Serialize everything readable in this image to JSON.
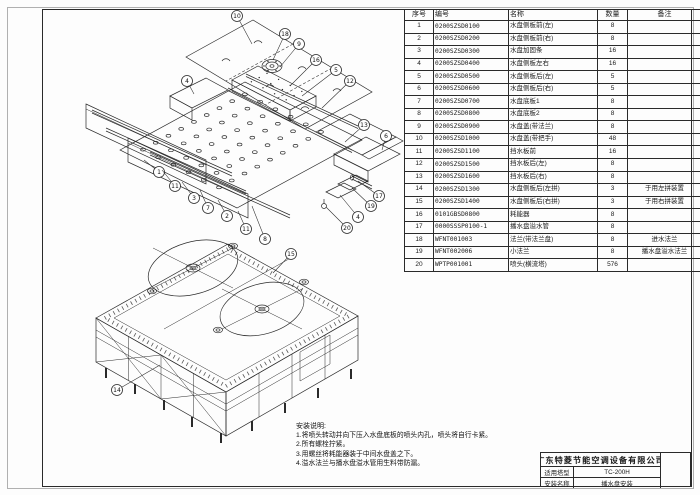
{
  "parts_table": {
    "headers": [
      "序号",
      "编号",
      "名称",
      "数量",
      "备注"
    ],
    "rows": [
      [
        "1",
        "0200SZSD0100",
        "水盘侧板前(左)",
        "8",
        ""
      ],
      [
        "2",
        "0200SZSD0200",
        "水盘侧板前(右)",
        "8",
        ""
      ],
      [
        "3",
        "0200SZSD0300",
        "水盘加固条",
        "16",
        ""
      ],
      [
        "4",
        "0200SZSD0400",
        "水盘侧板左右",
        "16",
        ""
      ],
      [
        "5",
        "0200SZSD0500",
        "水盘侧板后(左)",
        "5",
        ""
      ],
      [
        "6",
        "0200SZSD0600",
        "水盘侧板后(右)",
        "5",
        ""
      ],
      [
        "7",
        "0200SZSD0700",
        "水盘底板1",
        "8",
        ""
      ],
      [
        "8",
        "0200SZSD0800",
        "水盘底板2",
        "8",
        ""
      ],
      [
        "9",
        "0200SZSD0900",
        "水盘盖(带法兰)",
        "8",
        ""
      ],
      [
        "10",
        "0200SZSD1000",
        "水盘盖(带把手)",
        "48",
        ""
      ],
      [
        "11",
        "0200SZSD1100",
        "挡水板前",
        "16",
        ""
      ],
      [
        "12",
        "0200SZSD1500",
        "挡水板后(左)",
        "8",
        ""
      ],
      [
        "13",
        "0200SZSD1600",
        "挡水板后(右)",
        "8",
        ""
      ],
      [
        "14",
        "0200SZSD1300",
        "水盘侧板后(左拼)",
        "3",
        "于用左拼装置"
      ],
      [
        "15",
        "0200SZSD1400",
        "水盘侧板后(右拼)",
        "3",
        "于用右拼装置"
      ],
      [
        "16",
        "0101GBSD0800",
        "耗能器",
        "8",
        ""
      ],
      [
        "17",
        "0000SSSP0100-1",
        "播水盘溢水管",
        "8",
        ""
      ],
      [
        "18",
        "WFNT001003",
        "法兰(带法兰盘)",
        "8",
        "进水法兰"
      ],
      [
        "19",
        "WFNT002006",
        "小法兰",
        "8",
        "播水盘溢水法兰"
      ],
      [
        "20",
        "WPTP001001",
        "喷头(横流塔)",
        "576",
        ""
      ]
    ]
  },
  "notes": {
    "title": "安装说明:",
    "lines": [
      "1.将喷头转动并向下压入水盘底板的喷头内孔，喷头将自行卡紧。",
      "2.所有螺栓拧紧。",
      "3.用螺丝将耗能器装于中间水盘盖之下。",
      "4.溢水法兰与播水盘溢水管用生料带防漏。"
    ]
  },
  "title_block": {
    "company": "广东特菱节能空调设备有限公司",
    "rows": [
      {
        "label": "适用塔型",
        "value": "TC-200H"
      },
      {
        "label": "安装名称",
        "value": "播水盘安装"
      }
    ]
  },
  "diagram": {
    "line_color": "#2a2a2a",
    "balloons": [
      {
        "n": "10",
        "x": 237,
        "y": 16,
        "tx": 252,
        "ty": 44
      },
      {
        "n": "18",
        "x": 285,
        "y": 34,
        "tx": 273,
        "ty": 60
      },
      {
        "n": "9",
        "x": 299,
        "y": 44,
        "tx": 280,
        "ty": 67
      },
      {
        "n": "16",
        "x": 316,
        "y": 60,
        "tx": 290,
        "ty": 86
      },
      {
        "n": "5",
        "x": 336,
        "y": 70,
        "tx": 302,
        "ty": 96
      },
      {
        "n": "12",
        "x": 350,
        "y": 81,
        "tx": 322,
        "ty": 108
      },
      {
        "n": "4",
        "x": 187,
        "y": 81,
        "tx": 194,
        "ty": 94
      },
      {
        "n": "13",
        "x": 364,
        "y": 125,
        "tx": 345,
        "ty": 142
      },
      {
        "n": "6",
        "x": 386,
        "y": 136,
        "tx": 382,
        "ty": 150
      },
      {
        "n": "1",
        "x": 159,
        "y": 172,
        "tx": 144,
        "ty": 160
      },
      {
        "n": "11",
        "x": 175,
        "y": 186,
        "tx": 162,
        "ty": 170
      },
      {
        "n": "3",
        "x": 194,
        "y": 198,
        "tx": 182,
        "ty": 182
      },
      {
        "n": "7",
        "x": 208,
        "y": 208,
        "tx": 200,
        "ty": 190
      },
      {
        "n": "2",
        "x": 227,
        "y": 216,
        "tx": 218,
        "ty": 200
      },
      {
        "n": "11",
        "x": 246,
        "y": 229,
        "tx": 238,
        "ty": 211
      },
      {
        "n": "8",
        "x": 265,
        "y": 239,
        "tx": 252,
        "ty": 206
      },
      {
        "n": "17",
        "x": 379,
        "y": 196,
        "tx": 358,
        "ty": 181
      },
      {
        "n": "19",
        "x": 371,
        "y": 206,
        "tx": 352,
        "ty": 188
      },
      {
        "n": "4",
        "x": 358,
        "y": 217,
        "tx": 340,
        "ty": 195
      },
      {
        "n": "20",
        "x": 347,
        "y": 228,
        "tx": 326,
        "ty": 207
      },
      {
        "n": "15",
        "x": 291,
        "y": 254,
        "tx": 273,
        "ty": 273
      },
      {
        "n": "14",
        "x": 117,
        "y": 390,
        "tx": 160,
        "ty": 365
      }
    ]
  }
}
